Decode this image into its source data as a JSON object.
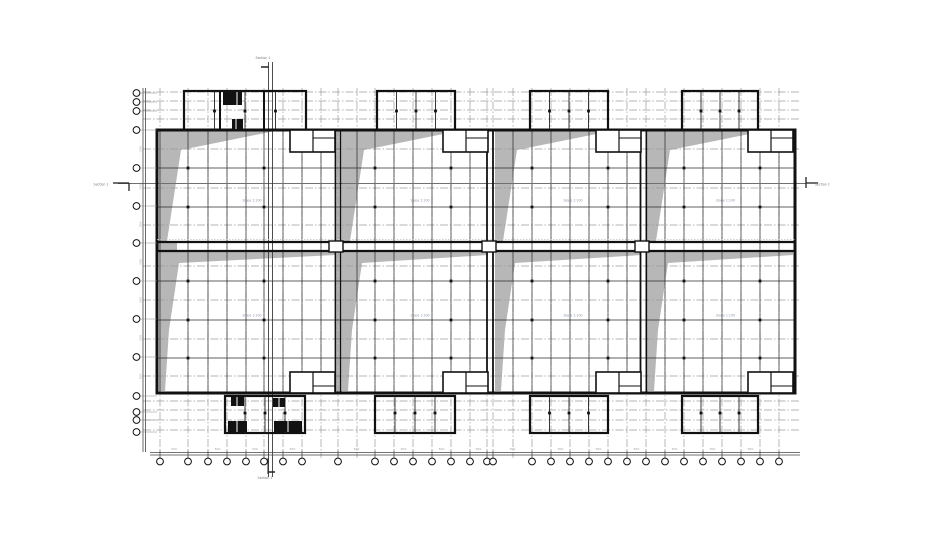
{
  "canvas": {
    "w": 949,
    "h": 534
  },
  "colors": {
    "ink": "#111111",
    "dark_grid": "#2b2b2b",
    "gray_grid": "#9c9c9c",
    "light_gray": "#c2c2c2",
    "wedge_fill": "#b7b7b7",
    "dim_text": "#98a2b0",
    "section_line": "#6f6f6f",
    "white": "#ffffff"
  },
  "labels": {
    "slope": "Slope 1:100",
    "section": "Section 1",
    "dim": "500"
  },
  "building": {
    "left": 157,
    "right": 795,
    "top": 130,
    "bottom": 393,
    "joint_top": 242,
    "joint_bottom": 251
  },
  "bays": [
    [
      157,
      337
    ],
    [
      340,
      490
    ],
    [
      493,
      643
    ],
    [
      646,
      795
    ]
  ],
  "separator_pairs": [
    [
      335.5,
      340.5
    ],
    [
      487,
      493
    ],
    [
      640.5,
      646.5
    ]
  ],
  "grid": {
    "vxs": [
      160,
      188,
      208,
      227,
      246,
      264,
      283,
      302,
      321,
      338,
      357,
      375,
      394,
      413,
      432,
      451,
      470,
      487,
      493,
      513,
      532,
      551,
      570,
      589,
      608,
      627,
      646,
      665,
      684,
      703,
      722,
      741,
      760,
      779
    ],
    "bubble_skip": [
      321,
      357,
      513
    ],
    "extra_bubble": [
      795
    ],
    "h_gray": [
      92,
      101,
      110,
      119,
      149,
      188,
      225,
      266,
      300,
      339,
      376,
      401,
      410,
      420,
      430
    ],
    "h_dark": [
      168,
      207,
      281,
      320,
      358
    ],
    "v_top": 88,
    "v_bottom": 458,
    "h_left": 143,
    "h_right": 800
  },
  "bubbles": {
    "bottom_y": 461.5,
    "r": 3.4,
    "left_x": 136.5,
    "left_ys": [
      93,
      102,
      111,
      130,
      168,
      206,
      243,
      281,
      319,
      357,
      396,
      412,
      420,
      432
    ]
  },
  "columns": {
    "xs": [
      188,
      264,
      375,
      451,
      532,
      608,
      684,
      760
    ],
    "ys": [
      168,
      207,
      281,
      320,
      358
    ],
    "size": 2.8
  },
  "protrusions_top": {
    "y1": 91,
    "y2": 130,
    "spans": [
      [
        184,
        306
      ],
      [
        377,
        455
      ],
      [
        530,
        608
      ],
      [
        682,
        758
      ]
    ],
    "heavy_inner": [
      220,
      264
    ],
    "dot_y": 111
  },
  "protrusions_bottom": {
    "y1": 396,
    "y2": 433,
    "spans": [
      [
        225,
        305
      ],
      [
        375,
        455
      ],
      [
        530,
        608
      ],
      [
        682,
        758
      ]
    ],
    "dot_y": 413
  },
  "stair_blocks": [
    [
      223,
      92,
      19,
      13
    ],
    [
      232,
      119,
      11,
      10
    ],
    [
      231,
      397,
      13,
      9
    ],
    [
      273,
      398,
      12,
      9
    ],
    [
      228,
      421,
      19,
      11
    ],
    [
      274,
      421,
      28,
      11
    ]
  ],
  "stair_slits": [
    [
      237,
      92,
      237,
      105
    ],
    [
      236,
      119,
      236,
      129
    ],
    [
      237,
      397,
      237,
      406
    ],
    [
      279,
      398,
      279,
      407
    ],
    [
      237,
      421,
      237,
      432
    ],
    [
      288,
      421,
      288,
      432
    ]
  ],
  "wedge_top": {
    "edge_run": 118,
    "kink_dx": 24,
    "kink_y": 150,
    "foot_dx": 10
  },
  "wedge_bottom": {
    "kink_dx": 22,
    "kink_y": 263,
    "mid_dx": 12,
    "mid_y": 330,
    "foot_dx": 8,
    "tip_y": 255
  },
  "notches": {
    "w": 47,
    "top_y": 130,
    "top_h": 22,
    "bottom_y": 372,
    "bottom_h": 21,
    "divider_dx": 24
  },
  "joint_boxes": [
    337,
    490,
    643
  ],
  "section_line": {
    "y": 183.5,
    "x1": 118,
    "x2": 806,
    "vx": [
      268.5,
      272.5
    ],
    "vy1": 62,
    "vy2": 477
  },
  "markers": {
    "left": {
      "x": 113,
      "y": 183
    },
    "right": {
      "x": 806,
      "y": 183
    },
    "top": {
      "x": 265,
      "y": 62
    },
    "bottom": {
      "x": 268,
      "y": 470
    }
  },
  "dimension": {
    "bottom_ys": [
      452.5,
      455
    ],
    "bottom_x1": 150,
    "bottom_x2": 800,
    "left_xs": [
      143,
      145.5
    ],
    "left_y1": 88,
    "left_y2": 452
  },
  "slope_label_rows": [
    200,
    315
  ]
}
